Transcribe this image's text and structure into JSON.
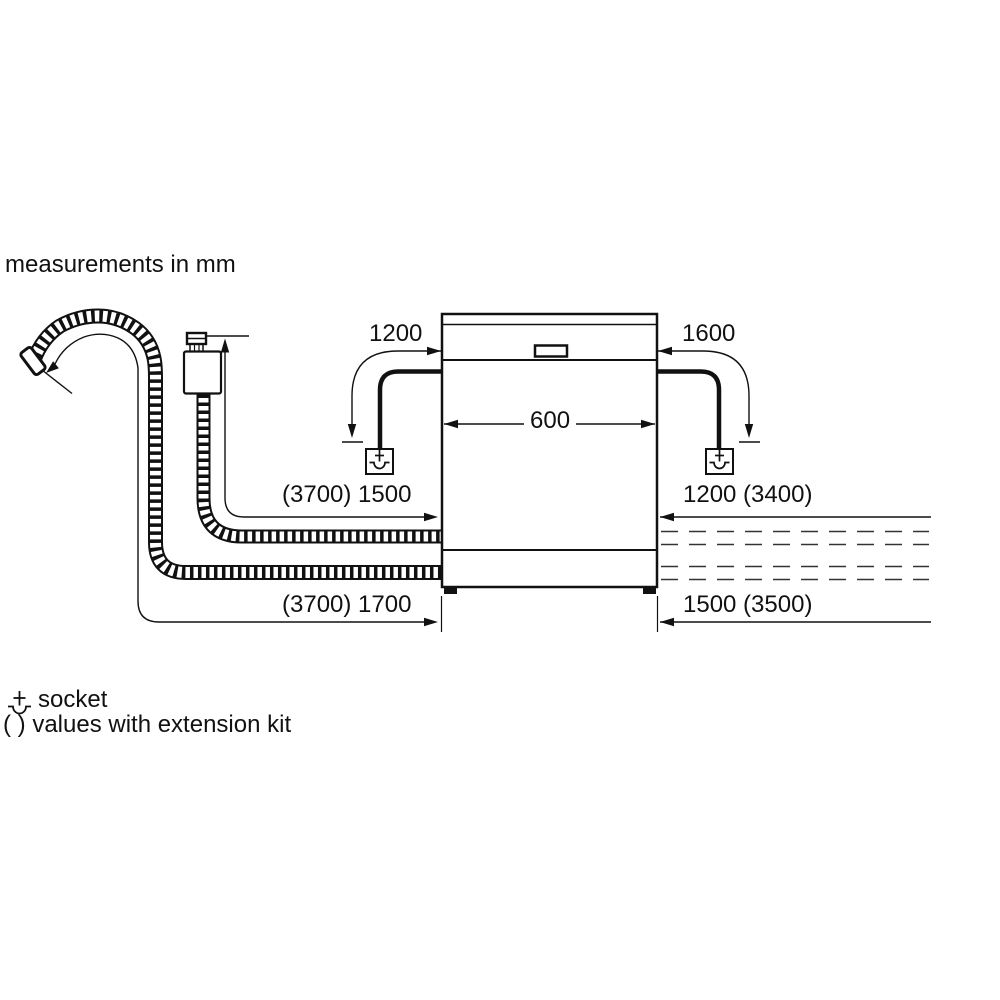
{
  "title": "measurements in mm",
  "diagram": {
    "type": "appliance-installation-clearances",
    "appliance": "dishwasher (front view)",
    "unit": "mm",
    "colors": {
      "line": "#111111",
      "background": "#ffffff"
    },
    "dimensions": {
      "cord_left": "1200",
      "cord_right": "1600",
      "appliance_width": "600",
      "supply_hose_left": "(3700) 1500",
      "drain_hose_left": "(3700) 1700",
      "hose_right_upper": "1200 (3400)",
      "hose_right_lower": "1500 (3500)"
    }
  },
  "legend": {
    "socket_label": "socket",
    "extension_label": "( ) values with extension kit",
    "socket_icon": "socket-schematic-symbol"
  }
}
